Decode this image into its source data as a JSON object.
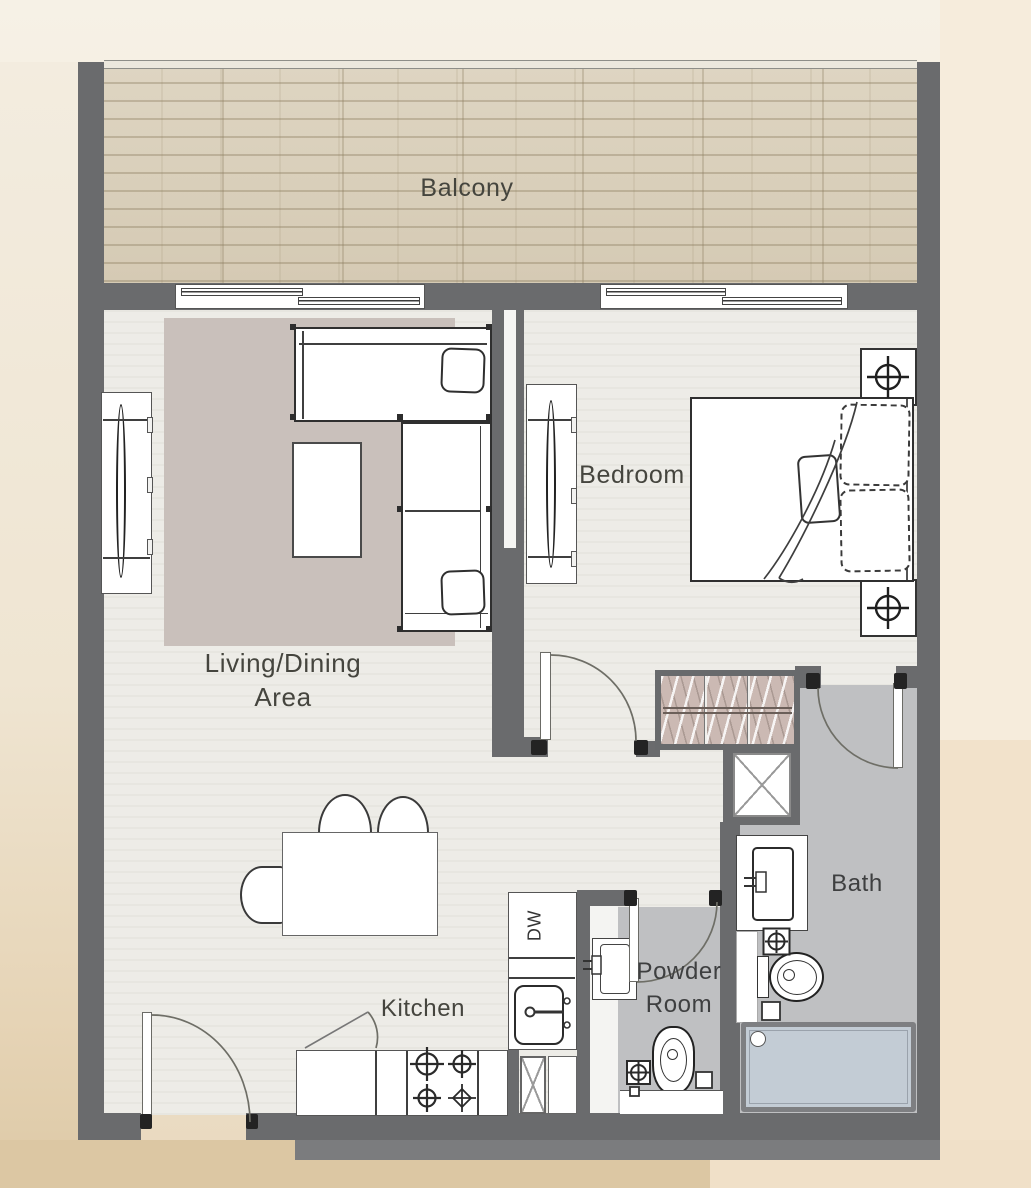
{
  "rooms": {
    "balcony": "Balcony",
    "living_line1": "Living/Dining",
    "living_line2": "Area",
    "bedroom": "Bedroom",
    "kitchen": "Kitchen",
    "powder_line1": "Powder",
    "powder_line2": "Room",
    "bath": "Bath"
  },
  "appliances": {
    "dishwasher_label": "DW"
  },
  "palette": {
    "wall": "#6a6b6d",
    "floor": "#edece7",
    "wet_floor": "#bfc0c2",
    "rug": "#c9c0bb",
    "balcony_plank": "#dbd2c0",
    "tub_fill": "#c3ccd5",
    "wardrobe_fill": "#cbb9b3",
    "outline": "#333333",
    "background": "#f0e7d6"
  }
}
